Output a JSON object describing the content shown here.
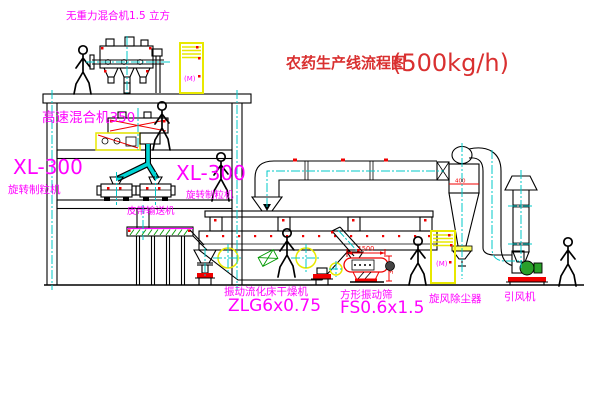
{
  "title": {
    "name": "农药生产线流程图",
    "capacity": "(500kg/h)"
  },
  "labels": {
    "gravity_mixer": "无重力混合机1.5 立方",
    "high_speed_mixer": "高速混合机350",
    "granulator_left_model": "XL-300",
    "granulator_left_name": "旋转制粒机",
    "granulator_right_model": "XL-300",
    "granulator_right_name": "旋转制粒机",
    "belt_conveyor": "皮带输送机",
    "dryer_name": "振动流化床干燥机",
    "dryer_model": "ZLG6x0.75",
    "sieve_name": "方形振动筛",
    "sieve_model": "FS0.6x1.5",
    "cyclone": "旋风除尘器",
    "fan": "引风机"
  },
  "dimensions": {
    "sieve_length": "1500",
    "sieve_height": "340",
    "cyclone_diameter": "400"
  },
  "cabinet_marks": {
    "cabinet1": "(M)",
    "cabinet2": "(M)"
  },
  "colors": {
    "label_magenta": "#ff00ff",
    "title_red": "#d93030",
    "centerline_cyan": "#00c8c8",
    "highlight_yellow": "#e8e800",
    "dimension_red": "#f00000",
    "hatch_green": "#009900",
    "line_black": "#000000"
  }
}
